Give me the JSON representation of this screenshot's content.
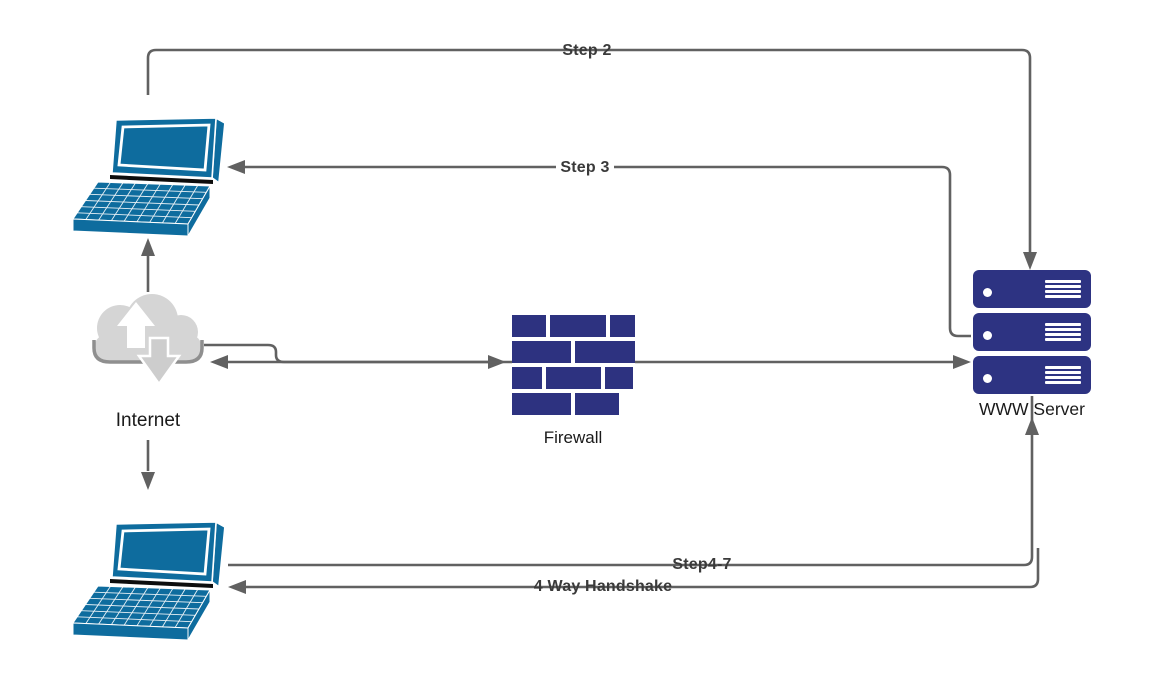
{
  "diagram": {
    "nodes": {
      "laptop_top": {
        "type": "laptop",
        "label": ""
      },
      "laptop_bottom": {
        "type": "laptop",
        "label": ""
      },
      "internet": {
        "type": "cloud",
        "label": "Internet"
      },
      "firewall": {
        "type": "brick-wall",
        "label": "Firewall"
      },
      "server": {
        "type": "server-stack",
        "label": "WWW Server"
      }
    },
    "edges": {
      "step2": {
        "label": "Step 2",
        "from": "laptop_top",
        "to": "server"
      },
      "step3": {
        "label": "Step 3",
        "from": "server",
        "to": "laptop_top"
      },
      "step4_7": {
        "label": "Step4-7",
        "from": "laptop_bottom",
        "to": "server"
      },
      "handshake": {
        "label": "4 Way Handshake",
        "from": "server",
        "to": "laptop_bottom"
      },
      "internet_up": {
        "label": "",
        "from": "internet",
        "to": "laptop_top"
      },
      "internet_down": {
        "label": "",
        "from": "internet",
        "to": "laptop_bottom"
      },
      "internet_firewall": {
        "label": "",
        "from": "internet",
        "to": "firewall"
      },
      "firewall_server": {
        "label": "",
        "from": "firewall",
        "to": "server"
      },
      "return_to_internet": {
        "label": "",
        "from": "server",
        "to": "internet"
      }
    },
    "colors": {
      "laptop": "#0e6c9e",
      "server": "#2d3382",
      "firewall_brick": "#2d3280",
      "cloud": "#d5d5d5",
      "cloud_edge": "#8f8f8f",
      "connector": "#616161",
      "edge_label_text": "#3a3a3a",
      "node_label_text": "#1a1a1a"
    }
  }
}
